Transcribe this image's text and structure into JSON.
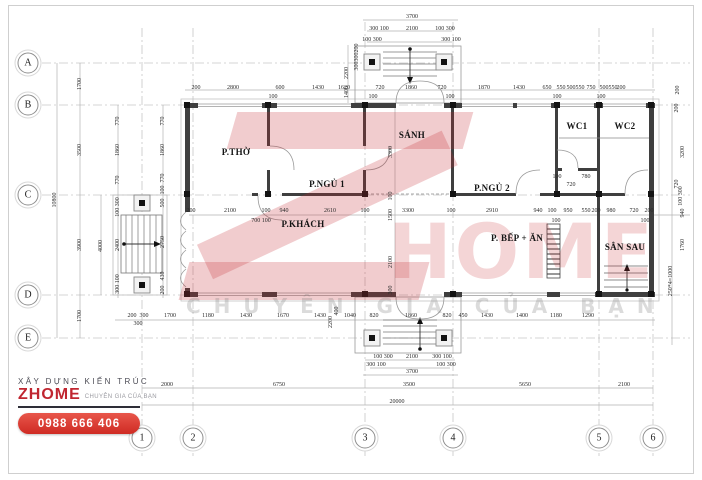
{
  "watermark": {
    "z_letter": "Z",
    "home_text": "HOME",
    "tagline": "CHUYÊN GIA CỦA BẠN",
    "color": "#c62b32"
  },
  "logo": {
    "line1": "XÂY DỰNG KIẾN TRÚC",
    "brand": "ZHOME",
    "tagline": "CHUYÊN GIA CỦA BẠN",
    "phone": "0988 666 406",
    "accent": "#c02630"
  },
  "grid": {
    "rows": [
      {
        "label": "A",
        "x": 28,
        "y": 63
      },
      {
        "label": "B",
        "x": 28,
        "y": 105
      },
      {
        "label": "C",
        "x": 28,
        "y": 195
      },
      {
        "label": "D",
        "x": 28,
        "y": 295
      },
      {
        "label": "E",
        "x": 28,
        "y": 338
      }
    ],
    "cols": [
      {
        "label": "1",
        "x": 142,
        "y": 438
      },
      {
        "label": "2",
        "x": 193,
        "y": 438
      },
      {
        "label": "3",
        "x": 365,
        "y": 438
      },
      {
        "label": "4",
        "x": 453,
        "y": 438
      },
      {
        "label": "5",
        "x": 599,
        "y": 438
      },
      {
        "label": "6",
        "x": 653,
        "y": 438
      }
    ]
  },
  "rooms": [
    {
      "label": "P.THỜ",
      "x": 236,
      "y": 152
    },
    {
      "label": "P.NGỦ 1",
      "x": 327,
      "y": 184
    },
    {
      "label": "SÁNH",
      "x": 412,
      "y": 135
    },
    {
      "label": "P.NGỦ 2",
      "x": 492,
      "y": 188
    },
    {
      "label": "P.KHÁCH",
      "x": 303,
      "y": 224
    },
    {
      "label": "P. BẾP + ĂN",
      "x": 517,
      "y": 238
    },
    {
      "label": "WC1",
      "x": 577,
      "y": 126
    },
    {
      "label": "WC2",
      "x": 625,
      "y": 126
    },
    {
      "label": "SÂN SAU",
      "x": 625,
      "y": 247
    }
  ],
  "dims": [
    {
      "t": "10800",
      "x": 55,
      "y": 200,
      "v": 1
    },
    {
      "t": "1700",
      "x": 80,
      "y": 84,
      "v": 1
    },
    {
      "t": "3500",
      "x": 80,
      "y": 150,
      "v": 1
    },
    {
      "t": "3900",
      "x": 80,
      "y": 245,
      "v": 1
    },
    {
      "t": "1700",
      "x": 80,
      "y": 316,
      "v": 1
    },
    {
      "t": "4000",
      "x": 101,
      "y": 246,
      "v": 1
    },
    {
      "t": "770",
      "x": 118,
      "y": 121,
      "v": 1
    },
    {
      "t": "1860",
      "x": 118,
      "y": 150,
      "v": 1
    },
    {
      "t": "770",
      "x": 118,
      "y": 180,
      "v": 1
    },
    {
      "t": "100 300",
      "x": 118,
      "y": 207,
      "v": 1
    },
    {
      "t": "2400",
      "x": 118,
      "y": 245,
      "v": 1
    },
    {
      "t": "300 100",
      "x": 118,
      "y": 284,
      "v": 1
    },
    {
      "t": "770",
      "x": 163,
      "y": 121,
      "v": 1
    },
    {
      "t": "1860",
      "x": 163,
      "y": 150,
      "v": 1
    },
    {
      "t": "770",
      "x": 163,
      "y": 178,
      "v": 1
    },
    {
      "t": "100",
      "x": 163,
      "y": 190,
      "v": 1
    },
    {
      "t": "500",
      "x": 163,
      "y": 203,
      "v": 1
    },
    {
      "t": "2750",
      "x": 163,
      "y": 242,
      "v": 1
    },
    {
      "t": "430",
      "x": 163,
      "y": 276,
      "v": 1
    },
    {
      "t": "200",
      "x": 163,
      "y": 290,
      "v": 1
    },
    {
      "t": "3700",
      "x": 412,
      "y": 17
    },
    {
      "t": "300 100",
      "x": 379,
      "y": 29
    },
    {
      "t": "2100",
      "x": 412,
      "y": 29
    },
    {
      "t": "100 300",
      "x": 445,
      "y": 29
    },
    {
      "t": "100 300",
      "x": 372,
      "y": 40
    },
    {
      "t": "300 100",
      "x": 451,
      "y": 40
    },
    {
      "t": "2200",
      "x": 347,
      "y": 73,
      "v": 1
    },
    {
      "t": "1400",
      "x": 347,
      "y": 92,
      "v": 1
    },
    {
      "t": "200",
      "x": 357,
      "y": 48,
      "v": 1
    },
    {
      "t": "300",
      "x": 357,
      "y": 57,
      "v": 1
    },
    {
      "t": "300",
      "x": 357,
      "y": 66,
      "v": 1
    },
    {
      "t": "200",
      "x": 196,
      "y": 88
    },
    {
      "t": "2800",
      "x": 233,
      "y": 88
    },
    {
      "t": "600",
      "x": 280,
      "y": 88
    },
    {
      "t": "100",
      "x": 273,
      "y": 97
    },
    {
      "t": "1430",
      "x": 318,
      "y": 88
    },
    {
      "t": "1620",
      "x": 344,
      "y": 88
    },
    {
      "t": "720",
      "x": 380,
      "y": 88
    },
    {
      "t": "1860",
      "x": 411,
      "y": 88
    },
    {
      "t": "720",
      "x": 442,
      "y": 88
    },
    {
      "t": "100",
      "x": 373,
      "y": 97
    },
    {
      "t": "100",
      "x": 450,
      "y": 97
    },
    {
      "t": "1870",
      "x": 484,
      "y": 88
    },
    {
      "t": "1430",
      "x": 519,
      "y": 88
    },
    {
      "t": "650",
      "x": 547,
      "y": 88
    },
    {
      "t": "550",
      "x": 561,
      "y": 88
    },
    {
      "t": "500",
      "x": 571,
      "y": 88
    },
    {
      "t": "550",
      "x": 580,
      "y": 88
    },
    {
      "t": "750",
      "x": 591,
      "y": 88
    },
    {
      "t": "500",
      "x": 604,
      "y": 88
    },
    {
      "t": "550",
      "x": 613,
      "y": 88
    },
    {
      "t": "200",
      "x": 621,
      "y": 88
    },
    {
      "t": "100",
      "x": 557,
      "y": 97
    },
    {
      "t": "100",
      "x": 601,
      "y": 97
    },
    {
      "t": "200",
      "x": 678,
      "y": 90,
      "v": 1
    },
    {
      "t": "200",
      "x": 191,
      "y": 211
    },
    {
      "t": "2100",
      "x": 230,
      "y": 211
    },
    {
      "t": "100",
      "x": 266,
      "y": 211
    },
    {
      "t": "940",
      "x": 284,
      "y": 211
    },
    {
      "t": "700 100",
      "x": 261,
      "y": 221
    },
    {
      "t": "2610",
      "x": 330,
      "y": 211
    },
    {
      "t": "100",
      "x": 365,
      "y": 211
    },
    {
      "t": "3300",
      "x": 408,
      "y": 211
    },
    {
      "t": "100",
      "x": 451,
      "y": 211
    },
    {
      "t": "2910",
      "x": 492,
      "y": 211
    },
    {
      "t": "940",
      "x": 538,
      "y": 211
    },
    {
      "t": "100",
      "x": 552,
      "y": 211
    },
    {
      "t": "100",
      "x": 556,
      "y": 221
    },
    {
      "t": "950",
      "x": 568,
      "y": 211
    },
    {
      "t": "550",
      "x": 586,
      "y": 211
    },
    {
      "t": "200",
      "x": 596,
      "y": 211
    },
    {
      "t": "980",
      "x": 611,
      "y": 211
    },
    {
      "t": "720",
      "x": 634,
      "y": 211
    },
    {
      "t": "200",
      "x": 649,
      "y": 211
    },
    {
      "t": "100",
      "x": 645,
      "y": 221
    },
    {
      "t": "100",
      "x": 557,
      "y": 177
    },
    {
      "t": "780",
      "x": 586,
      "y": 177
    },
    {
      "t": "720",
      "x": 571,
      "y": 185
    },
    {
      "t": "3300",
      "x": 391,
      "y": 152,
      "v": 1
    },
    {
      "t": "100",
      "x": 391,
      "y": 196,
      "v": 1
    },
    {
      "t": "1500",
      "x": 391,
      "y": 215,
      "v": 1
    },
    {
      "t": "2100",
      "x": 391,
      "y": 262,
      "v": 1
    },
    {
      "t": "300",
      "x": 391,
      "y": 290,
      "v": 1
    },
    {
      "t": "200",
      "x": 677,
      "y": 108,
      "v": 1
    },
    {
      "t": "3200",
      "x": 683,
      "y": 152,
      "v": 1
    },
    {
      "t": "720",
      "x": 677,
      "y": 184,
      "v": 1
    },
    {
      "t": "100 300",
      "x": 681,
      "y": 196,
      "v": 1
    },
    {
      "t": "940",
      "x": 683,
      "y": 213,
      "v": 1
    },
    {
      "t": "1760",
      "x": 683,
      "y": 245,
      "v": 1
    },
    {
      "t": "250*4=1000",
      "x": 671,
      "y": 281,
      "v": 1
    },
    {
      "t": "200",
      "x": 132,
      "y": 316
    },
    {
      "t": "300",
      "x": 144,
      "y": 316
    },
    {
      "t": "300",
      "x": 138,
      "y": 324
    },
    {
      "t": "1700",
      "x": 170,
      "y": 316
    },
    {
      "t": "1180",
      "x": 208,
      "y": 316
    },
    {
      "t": "1430",
      "x": 246,
      "y": 316
    },
    {
      "t": "1670",
      "x": 283,
      "y": 316
    },
    {
      "t": "1430",
      "x": 320,
      "y": 316
    },
    {
      "t": "400",
      "x": 337,
      "y": 311,
      "v": 1
    },
    {
      "t": "2200",
      "x": 331,
      "y": 322,
      "v": 1
    },
    {
      "t": "1040",
      "x": 350,
      "y": 316
    },
    {
      "t": "820",
      "x": 374,
      "y": 316
    },
    {
      "t": "1860",
      "x": 411,
      "y": 316
    },
    {
      "t": "820",
      "x": 447,
      "y": 316
    },
    {
      "t": "450",
      "x": 463,
      "y": 316
    },
    {
      "t": "1430",
      "x": 487,
      "y": 316
    },
    {
      "t": "1400",
      "x": 522,
      "y": 316
    },
    {
      "t": "1180",
      "x": 556,
      "y": 316
    },
    {
      "t": "1290",
      "x": 588,
      "y": 316
    },
    {
      "t": "100 300",
      "x": 383,
      "y": 357
    },
    {
      "t": "2100",
      "x": 412,
      "y": 357
    },
    {
      "t": "300 100",
      "x": 442,
      "y": 357
    },
    {
      "t": "300 100",
      "x": 376,
      "y": 365
    },
    {
      "t": "100 300",
      "x": 446,
      "y": 365
    },
    {
      "t": "3700",
      "x": 412,
      "y": 372
    },
    {
      "t": "2000",
      "x": 167,
      "y": 385
    },
    {
      "t": "6750",
      "x": 279,
      "y": 385
    },
    {
      "t": "3500",
      "x": 409,
      "y": 385
    },
    {
      "t": "5650",
      "x": 525,
      "y": 385
    },
    {
      "t": "2100",
      "x": 624,
      "y": 385
    },
    {
      "t": "20000",
      "x": 397,
      "y": 402
    }
  ]
}
